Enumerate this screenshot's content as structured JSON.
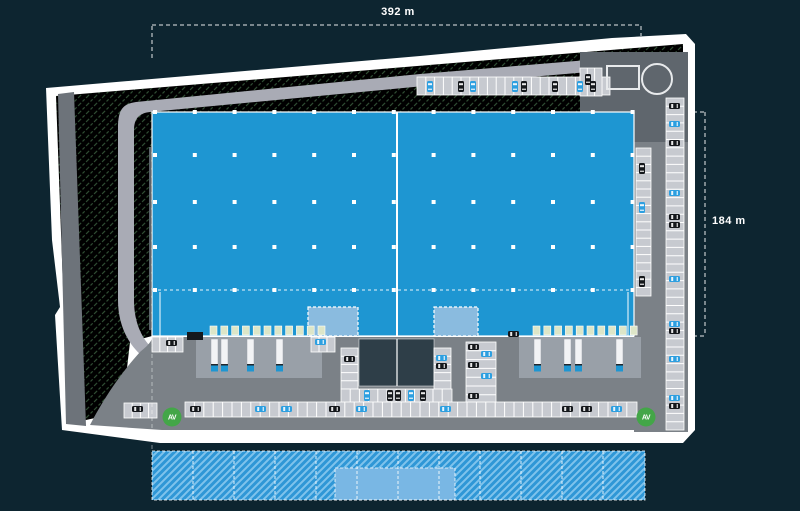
{
  "plan": {
    "dimensions": {
      "width_label": "392 m",
      "height_label": "184 m"
    },
    "colors": {
      "background": "#0d2530",
      "site_border": "#ffffff",
      "green_base": "#badcb8",
      "green_hatch": "#558a5c",
      "road_light": "#a9abb5",
      "left_strip": "#6d737a",
      "pavement_dark": "#5f666d",
      "yard_gray": "#7b8187",
      "apron_gray": "#99a0a8",
      "stall_fill": "#c7cad0",
      "building_blue": "#1e96d2",
      "office_blue": "#8abbdf",
      "dark_yard": "#2e3e48",
      "dock_door": "#dde6c8",
      "truck_trailer": "#f2f3f5",
      "car_blue": "#2d9fe0",
      "car_black": "#15181c",
      "entrance_green": "#43a648",
      "expansion_base": "#2f97d6",
      "expansion_hatch": "#7fc3ec",
      "expansion_solid": "#79b7e4"
    },
    "building": {
      "x": 152,
      "y": 112,
      "w": 482,
      "h": 224,
      "divider_x": 397,
      "dashed_line_y": 290,
      "grid": {
        "col_start": 155,
        "col_step": 39.8,
        "col_count": 13,
        "rows": [
          112,
          155,
          202,
          247,
          290
        ]
      }
    },
    "offices": [
      {
        "x": 308,
        "y": 307,
        "w": 50,
        "h": 29
      },
      {
        "x": 434,
        "y": 307,
        "w": 44,
        "h": 29
      }
    ],
    "dock_doors": {
      "size": 7,
      "y": 326,
      "groups": [
        {
          "start_x": 210,
          "count": 11,
          "step": 10.8
        },
        {
          "start_x": 533,
          "count": 10,
          "step": 10.8
        }
      ]
    },
    "aprons": [
      {
        "x": 196,
        "y": 337,
        "w": 126,
        "h": 41
      },
      {
        "x": 519,
        "y": 337,
        "w": 122,
        "h": 41
      }
    ],
    "central_yard": {
      "x": 359,
      "y": 339,
      "w": 75,
      "h": 47,
      "divider_x": 397
    },
    "gatehouse": {
      "x": 607,
      "y": 66,
      "w": 32,
      "h": 23
    },
    "tank": {
      "cx": 657,
      "cy": 79,
      "r": 15
    },
    "entrances": [
      {
        "cx": 172,
        "cy": 417,
        "label": "AV"
      },
      {
        "cx": 646,
        "cy": 417,
        "label": "AV"
      }
    ],
    "parking_strips": [
      {
        "x": 417,
        "y": 77,
        "w": 193,
        "h": 18,
        "dir": "v",
        "step": 8.8
      },
      {
        "x": 580,
        "y": 68,
        "w": 22,
        "h": 28,
        "dir": "v",
        "step": 7.3
      },
      {
        "x": 666,
        "y": 98,
        "w": 18,
        "h": 332,
        "dir": "h",
        "step": 8.3
      },
      {
        "x": 636,
        "y": 148,
        "w": 15,
        "h": 148,
        "dir": "h",
        "step": 8.2
      },
      {
        "x": 341,
        "y": 348,
        "w": 17,
        "h": 41,
        "dir": "h",
        "step": 8.2
      },
      {
        "x": 434,
        "y": 348,
        "w": 17,
        "h": 41,
        "dir": "h",
        "step": 8.2
      },
      {
        "x": 341,
        "y": 389,
        "w": 111,
        "h": 15,
        "dir": "v",
        "step": 9.2
      },
      {
        "x": 466,
        "y": 342,
        "w": 30,
        "h": 62,
        "dir": "h",
        "step": 8.8
      },
      {
        "x": 152,
        "y": 337,
        "w": 31,
        "h": 15,
        "dir": "v",
        "step": 7.8
      },
      {
        "x": 124,
        "y": 403,
        "w": 33,
        "h": 15,
        "dir": "v",
        "step": 8.2
      },
      {
        "x": 311,
        "y": 337,
        "w": 24,
        "h": 15,
        "dir": "v",
        "step": 8.0
      },
      {
        "x": 185,
        "y": 402,
        "w": 452,
        "h": 15,
        "dir": "v",
        "step": 9.4
      }
    ],
    "trucks": [
      {
        "x": 211,
        "y": 339
      },
      {
        "x": 221,
        "y": 339
      },
      {
        "x": 247,
        "y": 339
      },
      {
        "x": 276,
        "y": 339
      },
      {
        "x": 534,
        "y": 339
      },
      {
        "x": 564,
        "y": 339
      },
      {
        "x": 575,
        "y": 339
      },
      {
        "x": 616,
        "y": 339
      }
    ],
    "cars": [
      {
        "x": 427,
        "y": 81,
        "o": "v",
        "c": "blue"
      },
      {
        "x": 458,
        "y": 81,
        "o": "v",
        "c": "black"
      },
      {
        "x": 470,
        "y": 81,
        "o": "v",
        "c": "blue"
      },
      {
        "x": 512,
        "y": 81,
        "o": "v",
        "c": "blue"
      },
      {
        "x": 521,
        "y": 81,
        "o": "v",
        "c": "black"
      },
      {
        "x": 552,
        "y": 81,
        "o": "v",
        "c": "black"
      },
      {
        "x": 577,
        "y": 81,
        "o": "v",
        "c": "blue"
      },
      {
        "x": 590,
        "y": 81,
        "o": "v",
        "c": "black"
      },
      {
        "x": 585,
        "y": 74,
        "o": "v",
        "c": "black"
      },
      {
        "x": 669,
        "y": 103,
        "o": "h",
        "c": "black"
      },
      {
        "x": 669,
        "y": 121,
        "o": "h",
        "c": "blue"
      },
      {
        "x": 669,
        "y": 140,
        "o": "h",
        "c": "black"
      },
      {
        "x": 669,
        "y": 190,
        "o": "h",
        "c": "blue"
      },
      {
        "x": 669,
        "y": 214,
        "o": "h",
        "c": "black"
      },
      {
        "x": 669,
        "y": 222,
        "o": "h",
        "c": "black"
      },
      {
        "x": 669,
        "y": 276,
        "o": "h",
        "c": "blue"
      },
      {
        "x": 669,
        "y": 321,
        "o": "h",
        "c": "blue"
      },
      {
        "x": 669,
        "y": 328,
        "o": "h",
        "c": "black"
      },
      {
        "x": 669,
        "y": 356,
        "o": "h",
        "c": "blue"
      },
      {
        "x": 669,
        "y": 395,
        "o": "h",
        "c": "blue"
      },
      {
        "x": 669,
        "y": 403,
        "o": "h",
        "c": "black"
      },
      {
        "x": 639,
        "y": 163,
        "o": "v",
        "c": "black"
      },
      {
        "x": 639,
        "y": 202,
        "o": "v",
        "c": "blue"
      },
      {
        "x": 639,
        "y": 276,
        "o": "v",
        "c": "black"
      },
      {
        "x": 344,
        "y": 356,
        "o": "h",
        "c": "black"
      },
      {
        "x": 436,
        "y": 355,
        "o": "h",
        "c": "blue"
      },
      {
        "x": 436,
        "y": 363,
        "o": "h",
        "c": "black"
      },
      {
        "x": 364,
        "y": 390,
        "o": "v",
        "c": "blue"
      },
      {
        "x": 387,
        "y": 390,
        "o": "v",
        "c": "black"
      },
      {
        "x": 395,
        "y": 390,
        "o": "v",
        "c": "black"
      },
      {
        "x": 408,
        "y": 390,
        "o": "v",
        "c": "blue"
      },
      {
        "x": 420,
        "y": 390,
        "o": "v",
        "c": "black"
      },
      {
        "x": 468,
        "y": 344,
        "o": "h",
        "c": "black"
      },
      {
        "x": 481,
        "y": 351,
        "o": "h",
        "c": "blue"
      },
      {
        "x": 468,
        "y": 362,
        "o": "h",
        "c": "black"
      },
      {
        "x": 481,
        "y": 373,
        "o": "h",
        "c": "blue"
      },
      {
        "x": 468,
        "y": 393,
        "o": "h",
        "c": "black"
      },
      {
        "x": 166,
        "y": 340,
        "o": "h",
        "c": "black"
      },
      {
        "x": 132,
        "y": 406,
        "o": "h",
        "c": "black"
      },
      {
        "x": 315,
        "y": 339,
        "o": "h",
        "c": "blue"
      },
      {
        "x": 508,
        "y": 331,
        "o": "h",
        "c": "black"
      },
      {
        "x": 190,
        "y": 406,
        "o": "h",
        "c": "black"
      },
      {
        "x": 255,
        "y": 406,
        "o": "h",
        "c": "blue"
      },
      {
        "x": 281,
        "y": 406,
        "o": "h",
        "c": "blue"
      },
      {
        "x": 329,
        "y": 406,
        "o": "h",
        "c": "black"
      },
      {
        "x": 356,
        "y": 406,
        "o": "h",
        "c": "blue"
      },
      {
        "x": 440,
        "y": 406,
        "o": "h",
        "c": "blue"
      },
      {
        "x": 562,
        "y": 406,
        "o": "h",
        "c": "black"
      },
      {
        "x": 581,
        "y": 406,
        "o": "h",
        "c": "black"
      },
      {
        "x": 611,
        "y": 406,
        "o": "h",
        "c": "blue"
      }
    ],
    "expansion": {
      "x": 152,
      "y": 451,
      "w": 493,
      "h": 49,
      "divider_start": 193,
      "divider_step": 41,
      "divider_count": 11,
      "solid": {
        "x": 335,
        "y": 468,
        "w": 120,
        "h": 32
      }
    },
    "dimension_lines": [
      {
        "x1": 152,
        "y1": 25,
        "x2": 641,
        "y2": 25
      },
      {
        "x1": 152,
        "y1": 26,
        "x2": 152,
        "y2": 58
      },
      {
        "x1": 641,
        "y1": 26,
        "x2": 641,
        "y2": 36
      },
      {
        "x1": 705,
        "y1": 112,
        "x2": 705,
        "y2": 336
      },
      {
        "x1": 693,
        "y1": 112,
        "x2": 705,
        "y2": 112
      },
      {
        "x1": 693,
        "y1": 336,
        "x2": 705,
        "y2": 336
      },
      {
        "x1": 152,
        "y1": 340,
        "x2": 152,
        "y2": 450
      }
    ]
  }
}
